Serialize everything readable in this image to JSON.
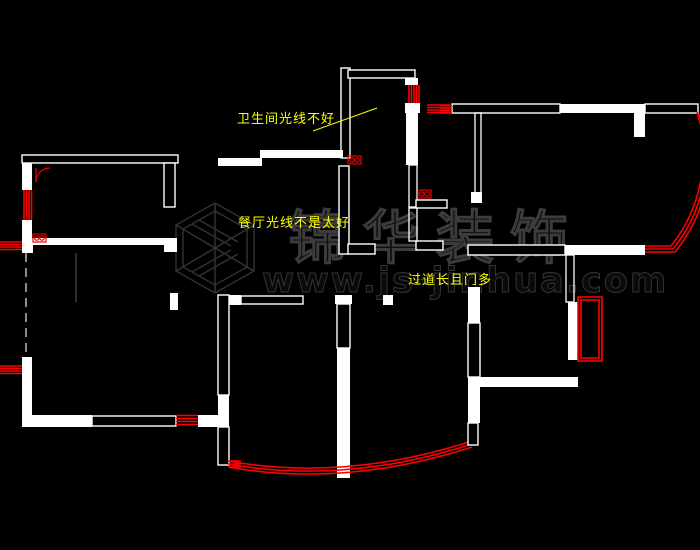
{
  "meta": {
    "app": "cad-floor-plan-viewer",
    "background": "#000000",
    "drawing_type": "apartment floor plan critique"
  },
  "colors": {
    "wall_white": "#ffffff",
    "accent_red": "#ff0000",
    "annotation_yellow": "#ffff00",
    "watermark_gray": "#3c3c3c",
    "hidden_wall_gray": "#8a8a8a"
  },
  "annotations": [
    {
      "id": "bathroom-light",
      "text": "卫生间光线不好"
    },
    {
      "id": "dining-light",
      "text": "餐厅光线不是太好"
    },
    {
      "id": "corridor",
      "text": "过道长且门多"
    }
  ],
  "watermark": {
    "brand": "锦华装饰",
    "url": "www.js-jinhua.com",
    "logo_icon": "isometric-cube-logo-icon"
  },
  "symbols": {
    "double_circle_fixture": "red rectangle containing two circles",
    "window_hatch": "parallel red lines in wall opening",
    "bay_window": "triple red arc / nested red rectangles",
    "door_swing": "red quarter-circle arc"
  }
}
